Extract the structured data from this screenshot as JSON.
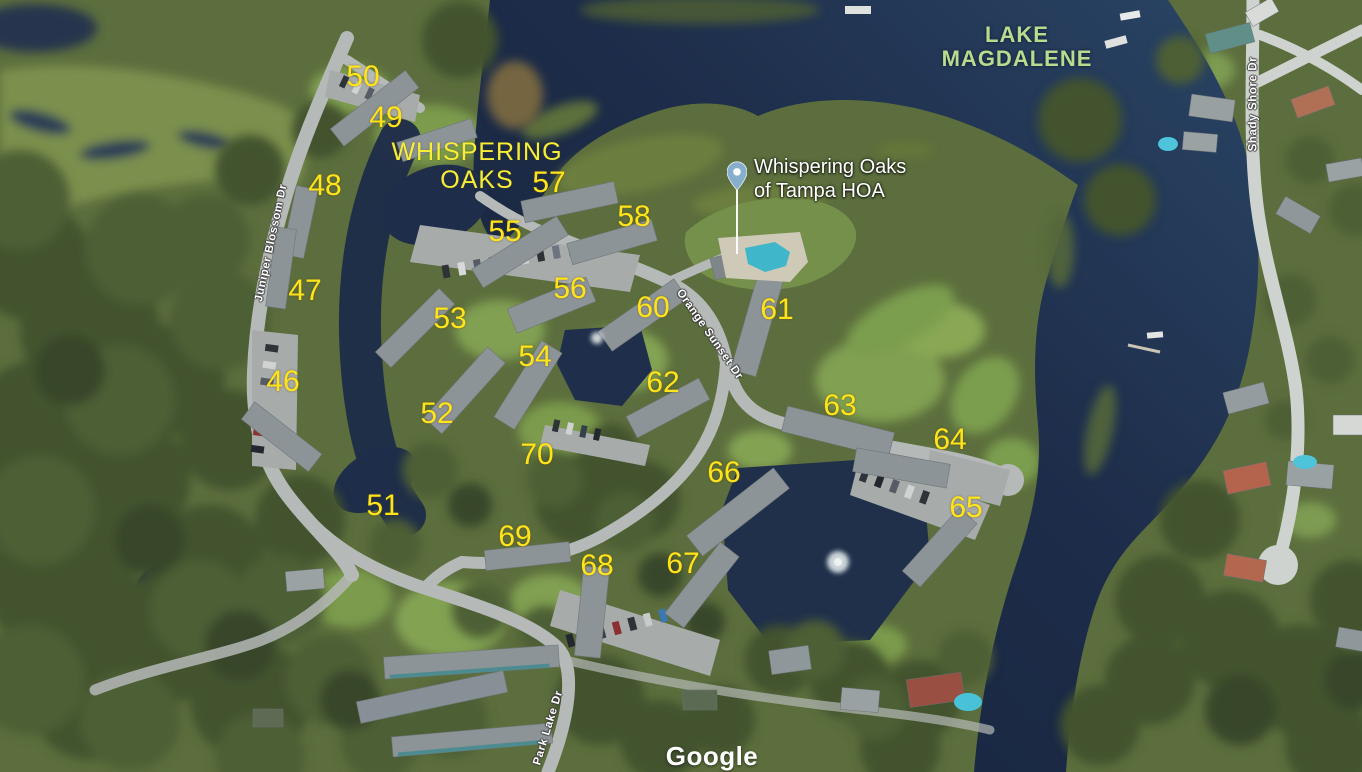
{
  "map": {
    "provider_watermark": "Google",
    "colors": {
      "unit_number": "#ffe41c",
      "community_label": "#f6ee38",
      "lake_label": "#b8db8e",
      "street_label": "#ffffff",
      "pin_fill": "#87afcd",
      "water": "#1d2c49"
    },
    "lake_label": {
      "line1": "LAKE",
      "line2": "MAGDALENE"
    },
    "community_label": {
      "line1": "WHISPERING",
      "line2": "OAKS"
    },
    "pin_label": {
      "line1": "Whispering Oaks",
      "line2": "of Tampa HOA"
    },
    "streets": [
      {
        "name": "Juniper Blossom Dr",
        "x": 272,
        "y": 243,
        "rotation": -78
      },
      {
        "name": "Orange Sunset Dr",
        "x": 709,
        "y": 335,
        "rotation": 55
      },
      {
        "name": "Park Lake Dr",
        "x": 549,
        "y": 728,
        "rotation": -73
      },
      {
        "name": "Shady Shore Dr",
        "x": 1254,
        "y": 104,
        "rotation": -90
      }
    ],
    "unit_numbers": [
      {
        "label": "46",
        "x": 283,
        "y": 382
      },
      {
        "label": "47",
        "x": 305,
        "y": 291
      },
      {
        "label": "48",
        "x": 325,
        "y": 186
      },
      {
        "label": "49",
        "x": 386,
        "y": 118
      },
      {
        "label": "50",
        "x": 363,
        "y": 77
      },
      {
        "label": "51",
        "x": 383,
        "y": 506
      },
      {
        "label": "52",
        "x": 437,
        "y": 414
      },
      {
        "label": "53",
        "x": 450,
        "y": 319
      },
      {
        "label": "54",
        "x": 535,
        "y": 357
      },
      {
        "label": "55",
        "x": 505,
        "y": 232
      },
      {
        "label": "56",
        "x": 570,
        "y": 289
      },
      {
        "label": "57",
        "x": 549,
        "y": 183
      },
      {
        "label": "58",
        "x": 634,
        "y": 217
      },
      {
        "label": "60",
        "x": 653,
        "y": 308
      },
      {
        "label": "61",
        "x": 777,
        "y": 310
      },
      {
        "label": "62",
        "x": 663,
        "y": 383
      },
      {
        "label": "63",
        "x": 840,
        "y": 406
      },
      {
        "label": "64",
        "x": 950,
        "y": 440
      },
      {
        "label": "65",
        "x": 966,
        "y": 508
      },
      {
        "label": "66",
        "x": 724,
        "y": 473
      },
      {
        "label": "67",
        "x": 683,
        "y": 564
      },
      {
        "label": "68",
        "x": 597,
        "y": 566
      },
      {
        "label": "69",
        "x": 515,
        "y": 537
      },
      {
        "label": "70",
        "x": 537,
        "y": 455
      }
    ]
  }
}
